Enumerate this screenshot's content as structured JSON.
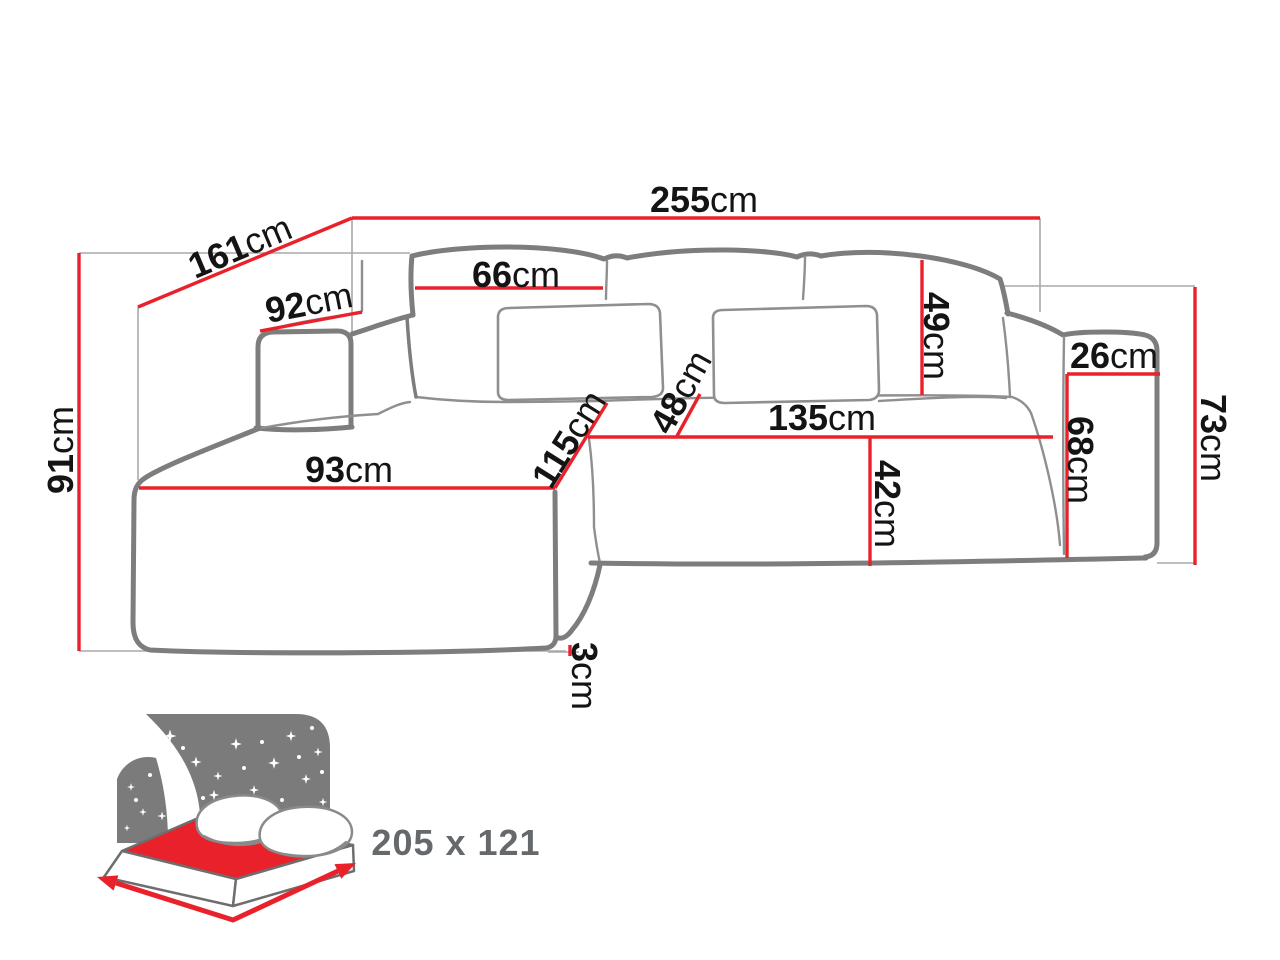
{
  "title": "Corner sofa dimension diagram",
  "colors": {
    "dimension_red": "#e8212a",
    "outline_gray": "#7d7d7d",
    "thin_gray": "#8f8f8f",
    "extension_gray": "#a9a9a9",
    "label_black": "#141414",
    "muted_gray": "#66696c",
    "headboard_gray": "#7b7b7b",
    "mattress_red": "#e8212b",
    "background_white": "#ffffff"
  },
  "dims": {
    "total_width": {
      "num": "255",
      "unit": "cm"
    },
    "chaise_depth_diagonal": {
      "num": "161",
      "unit": "cm"
    },
    "armrest_left_top": {
      "num": "92",
      "unit": "cm"
    },
    "back_cushion_width": {
      "num": "66",
      "unit": "cm"
    },
    "back_cushion_height": {
      "num": "49",
      "unit": "cm"
    },
    "armrest_top_width": {
      "num": "26",
      "unit": "cm"
    },
    "right_side_height": {
      "num": "73",
      "unit": "cm"
    },
    "armrest_front_height": {
      "num": "68",
      "unit": "cm"
    },
    "seat_front_width": {
      "num": "135",
      "unit": "cm"
    },
    "seat_front_height": {
      "num": "42",
      "unit": "cm"
    },
    "seat_gap_depth": {
      "num": "48",
      "unit": "cm"
    },
    "chaise_seat_depth": {
      "num": "115",
      "unit": "cm"
    },
    "chaise_front_width": {
      "num": "93",
      "unit": "cm"
    },
    "total_height": {
      "num": "91",
      "unit": "cm"
    },
    "feet_height": {
      "num": "3",
      "unit": "cm"
    }
  },
  "bed_icon": {
    "name": "sleeping-function-bed-icon",
    "sleeping_area": "205 x 121"
  }
}
